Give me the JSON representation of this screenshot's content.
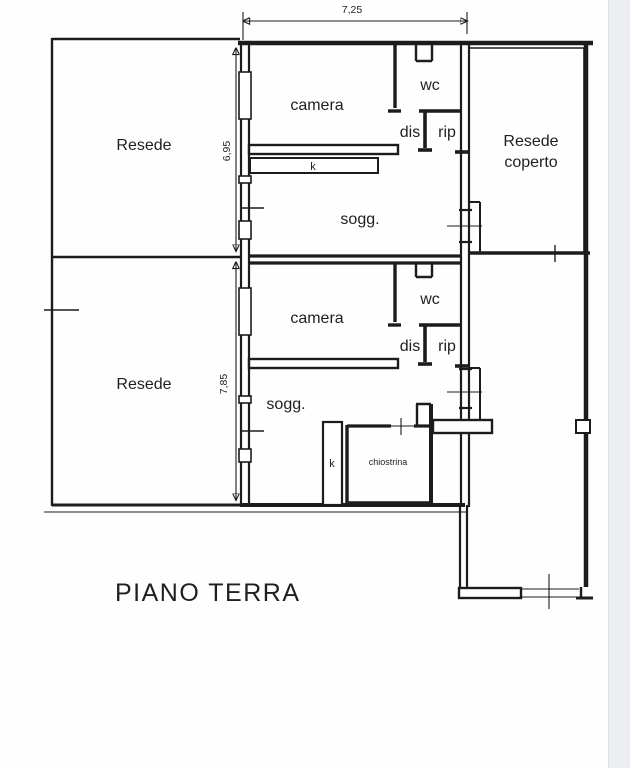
{
  "plan": {
    "title": "PIANO TERRA",
    "dimensions": {
      "width_top": "7,25",
      "height_upper": "6,95",
      "height_lower": "7,85"
    },
    "rooms": {
      "resede_upper": "Resede",
      "resede_lower": "Resede",
      "resede_coperto_line1": "Resede",
      "resede_coperto_line2": "coperto",
      "camera_upper": "camera",
      "camera_lower": "camera",
      "wc_upper": "wc",
      "wc_lower": "wc",
      "dis_upper": "dis",
      "dis_lower": "dis",
      "rip_upper": "rip",
      "rip_lower": "rip",
      "sogg_upper": "sogg.",
      "sogg_lower": "sogg.",
      "kitchen_upper": "k",
      "kitchen_lower": "k",
      "chiostrina": "chiostrina"
    },
    "colors": {
      "line": "#1c1c1c",
      "background": "#ffffff",
      "page_edge": "#eceef2"
    }
  }
}
